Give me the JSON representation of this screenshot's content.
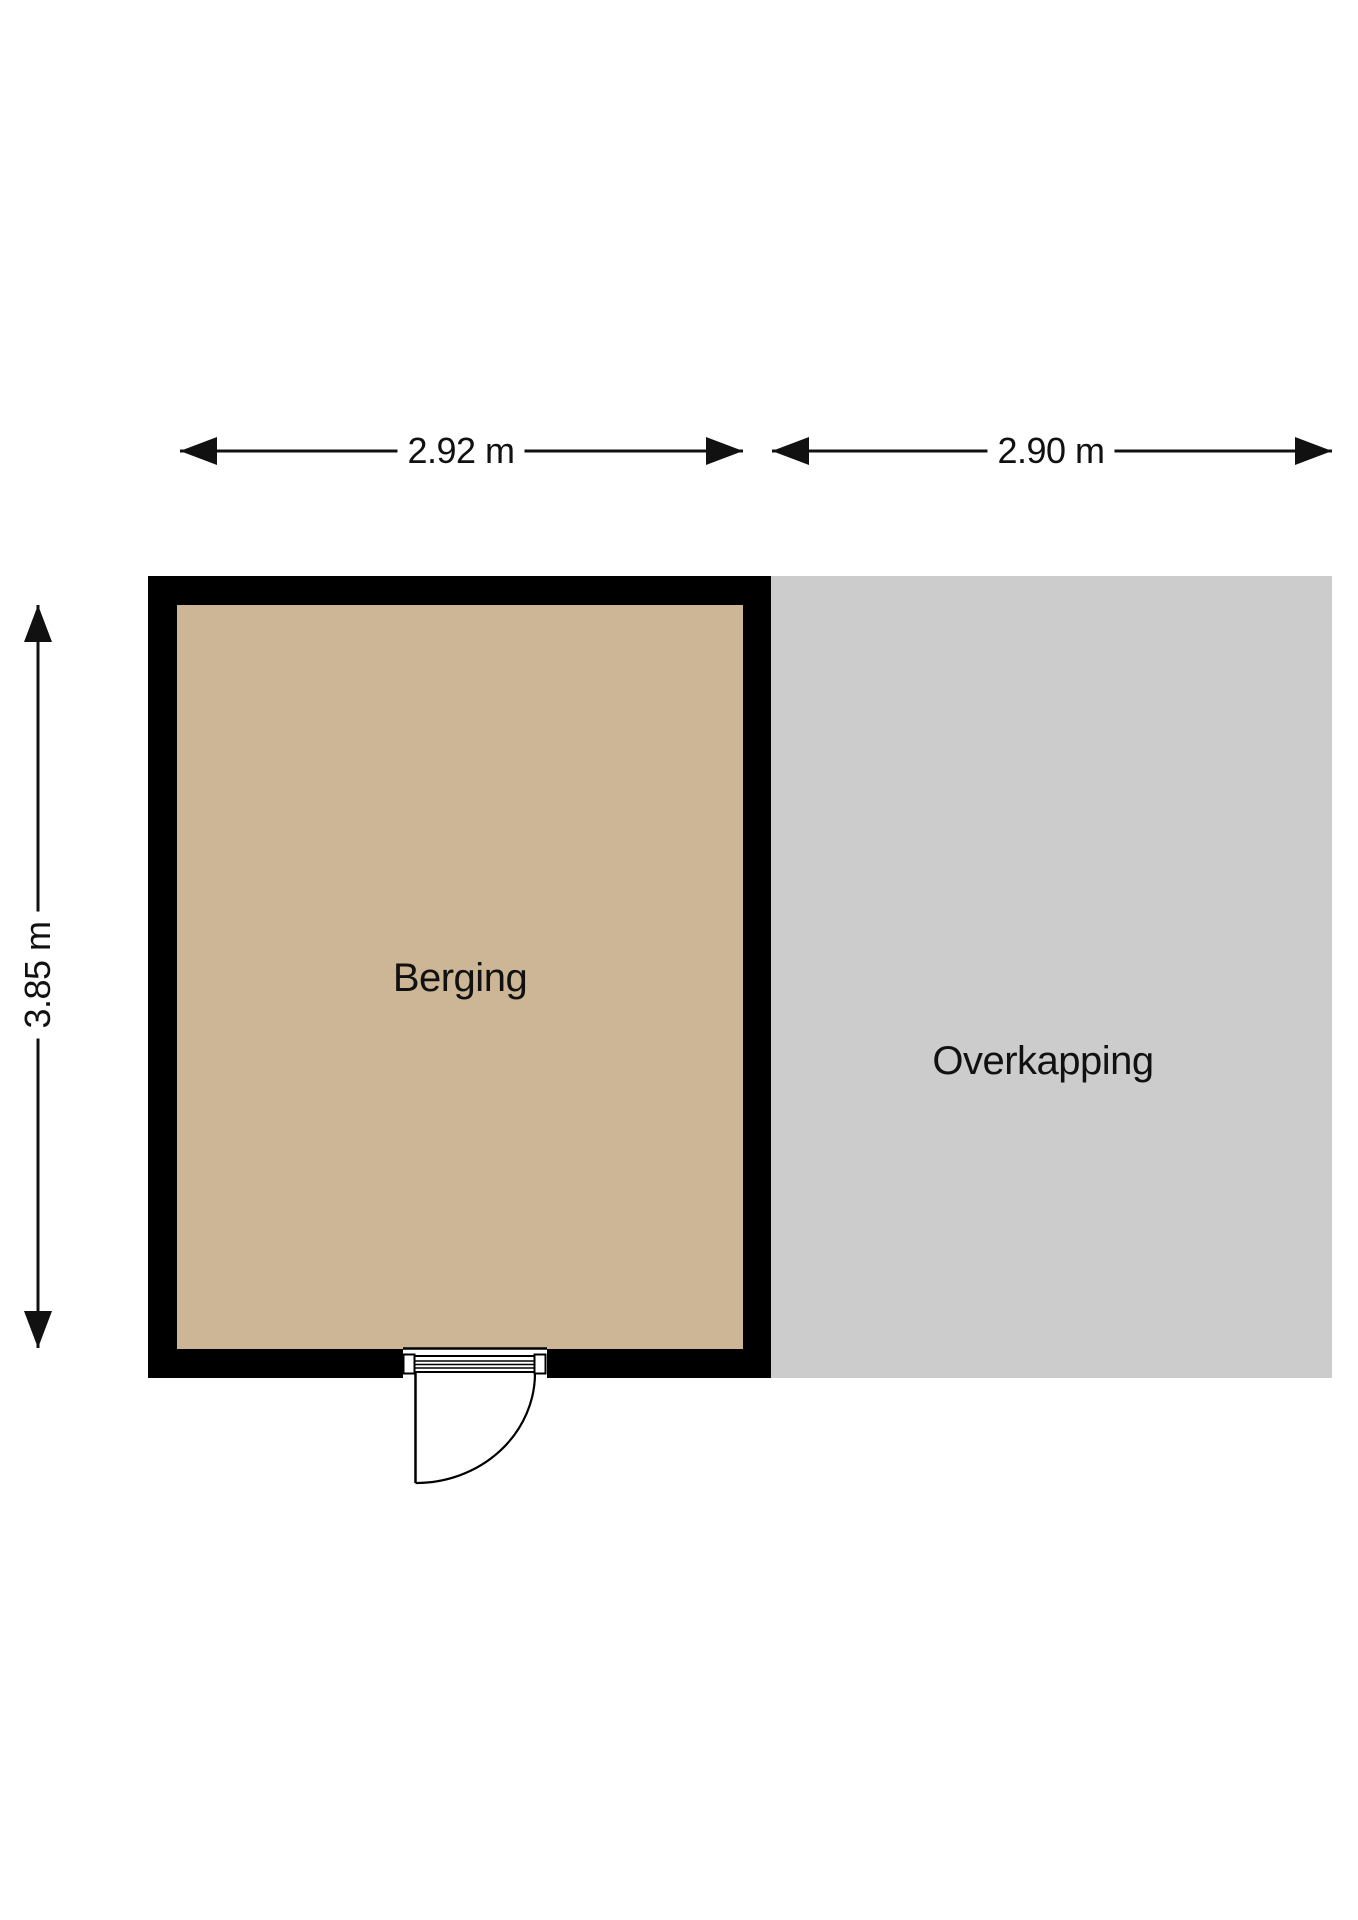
{
  "floorplan": {
    "rooms": [
      {
        "label": "Berging",
        "floor_color": "#cdb696"
      },
      {
        "label": "Overkapping",
        "floor_color": "#cccccc"
      }
    ],
    "dimensions": [
      {
        "label": "2.92 m",
        "edge": "top",
        "room": "Berging"
      },
      {
        "label": "2.90 m",
        "edge": "top",
        "room": "Overkapping"
      },
      {
        "label": "3.85 m",
        "edge": "left",
        "room": "Berging"
      }
    ],
    "colors": {
      "background": "#ffffff",
      "wall": "#000000",
      "line": "#111111",
      "text": "#111111"
    }
  }
}
